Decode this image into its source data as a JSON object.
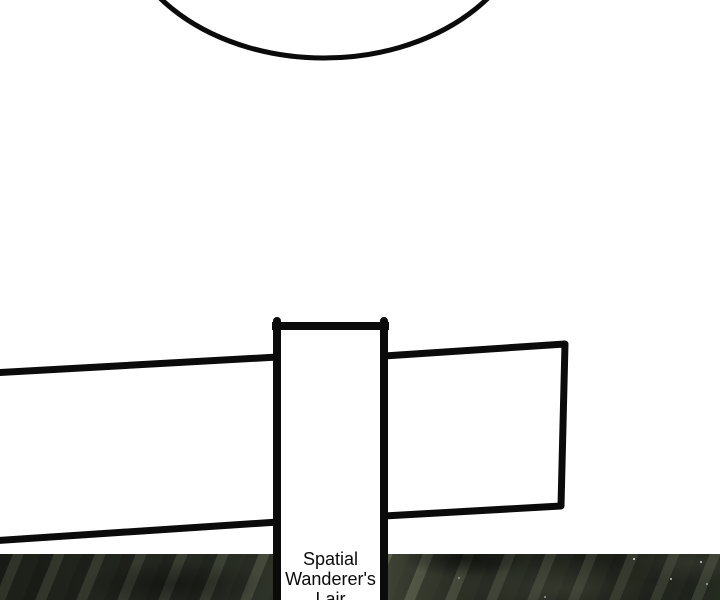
{
  "sign": {
    "text": "Spatial Wanderer's Lair"
  },
  "colors": {
    "ink": "#0b0b0b",
    "paper": "#ffffff",
    "strip_dark": "#20241d",
    "strip_mid": "#2e332a",
    "strip_light": "#565b49",
    "speck": "#f4f4ee"
  }
}
